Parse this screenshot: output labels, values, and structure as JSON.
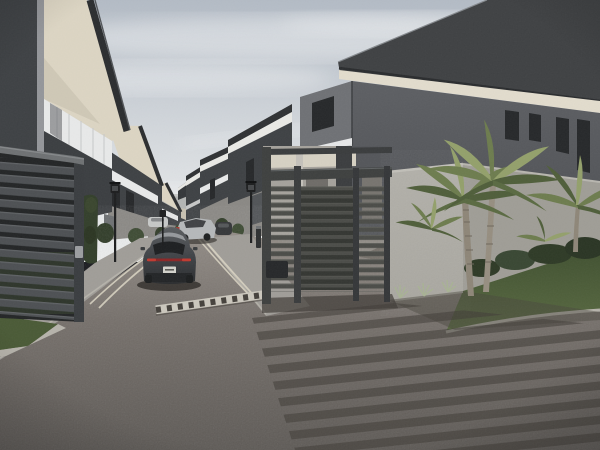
{
  "meta": {
    "kind": "3d-architectural-render",
    "subject": "Gated residential townhouse complex entrance with slatted sliding gate, internal street, departing car, palm trees and lawn",
    "width_px": 600,
    "height_px": 450
  },
  "scene": {
    "objects": [
      "sky",
      "clouds",
      "left-townhouse-row",
      "right-townhouse-row",
      "corner-house",
      "boundary-wall",
      "entrance-gate",
      "slat-fence",
      "street",
      "road-markings",
      "speed-bump",
      "dark-sedan",
      "silver-sedan",
      "street-lamps",
      "palm-trees",
      "shrubs",
      "lawn",
      "hedge",
      "gate-shadow-stripes",
      "end-wall"
    ]
  },
  "colors": {
    "sky_top": "#b3bbc5",
    "sky_horizon": "#e9ebec",
    "cloud": "#f3f4f5",
    "building_dark": "#3e4144",
    "building_dark_2": "#34373a",
    "gutter_gray": "#94969a",
    "soffit_cream": "#dcd5c3",
    "soffit_cream_dim": "#c9c2b1",
    "fascia_dark": "#2b2d2f",
    "panel_white": "#e8e9e9",
    "fascia_white": "#e9e9e5",
    "lower_wall_gray": "#8a8884",
    "window_dark": "#26282a",
    "house_wall": "#5d5f63",
    "house_wall_light": "#6f7175",
    "roof_dark": "#3f4143",
    "house_soffit": "#e2dccd",
    "balcony_white": "#e6e7e8",
    "recess_dark": "#34363a",
    "end_wall": "#b3b5b4",
    "boundary_wall": "#a9a7a0",
    "boundary_wall_side": "#9f9d96",
    "gate_slat": "#4b4c48",
    "gate_slat_hl": "#5e5f5a",
    "gate_frame": "#3e403f",
    "gate_inner": "#343632",
    "fence_slat": "#4d5053",
    "fence_cap": "#6e7173",
    "fence_bg": "#232526",
    "road_far": "#918b85",
    "road_mid": "#746e69",
    "road_near": "#5c5854",
    "sidewalk": "#a09d98",
    "curb": "#b6b3ab",
    "marking": "#d7d1c1",
    "bump_white": "#cbc7bd",
    "bump_dark": "#45413c",
    "grass": "#4a5a36",
    "lawn_light": "#5a6b42",
    "lawn_dark": "#3e4e2f",
    "hedge": "#333f2b",
    "shrub": "#2e3a26",
    "palm_light": "#93a06b",
    "palm_mid": "#6d7c4e",
    "palm_dark": "#4f5e3a",
    "trunk": "#8e8678",
    "car_body": "#3e4145",
    "car_roof_hl": "#9da1a4",
    "car_glass": "#1d1f21",
    "taillight": "#c13a30",
    "plate": "#d3d3cc",
    "car_lower": "#232527",
    "car_silver": "#b5b8ba",
    "car_silver_glass": "#404245",
    "lamp_black": "#1d1e1f",
    "stripe_shadow": "#403c37",
    "backdrop_wall": "#a5a29c",
    "backdrop_ground": "#8f8b85",
    "backdrop_cream": "#d6d1c3"
  }
}
